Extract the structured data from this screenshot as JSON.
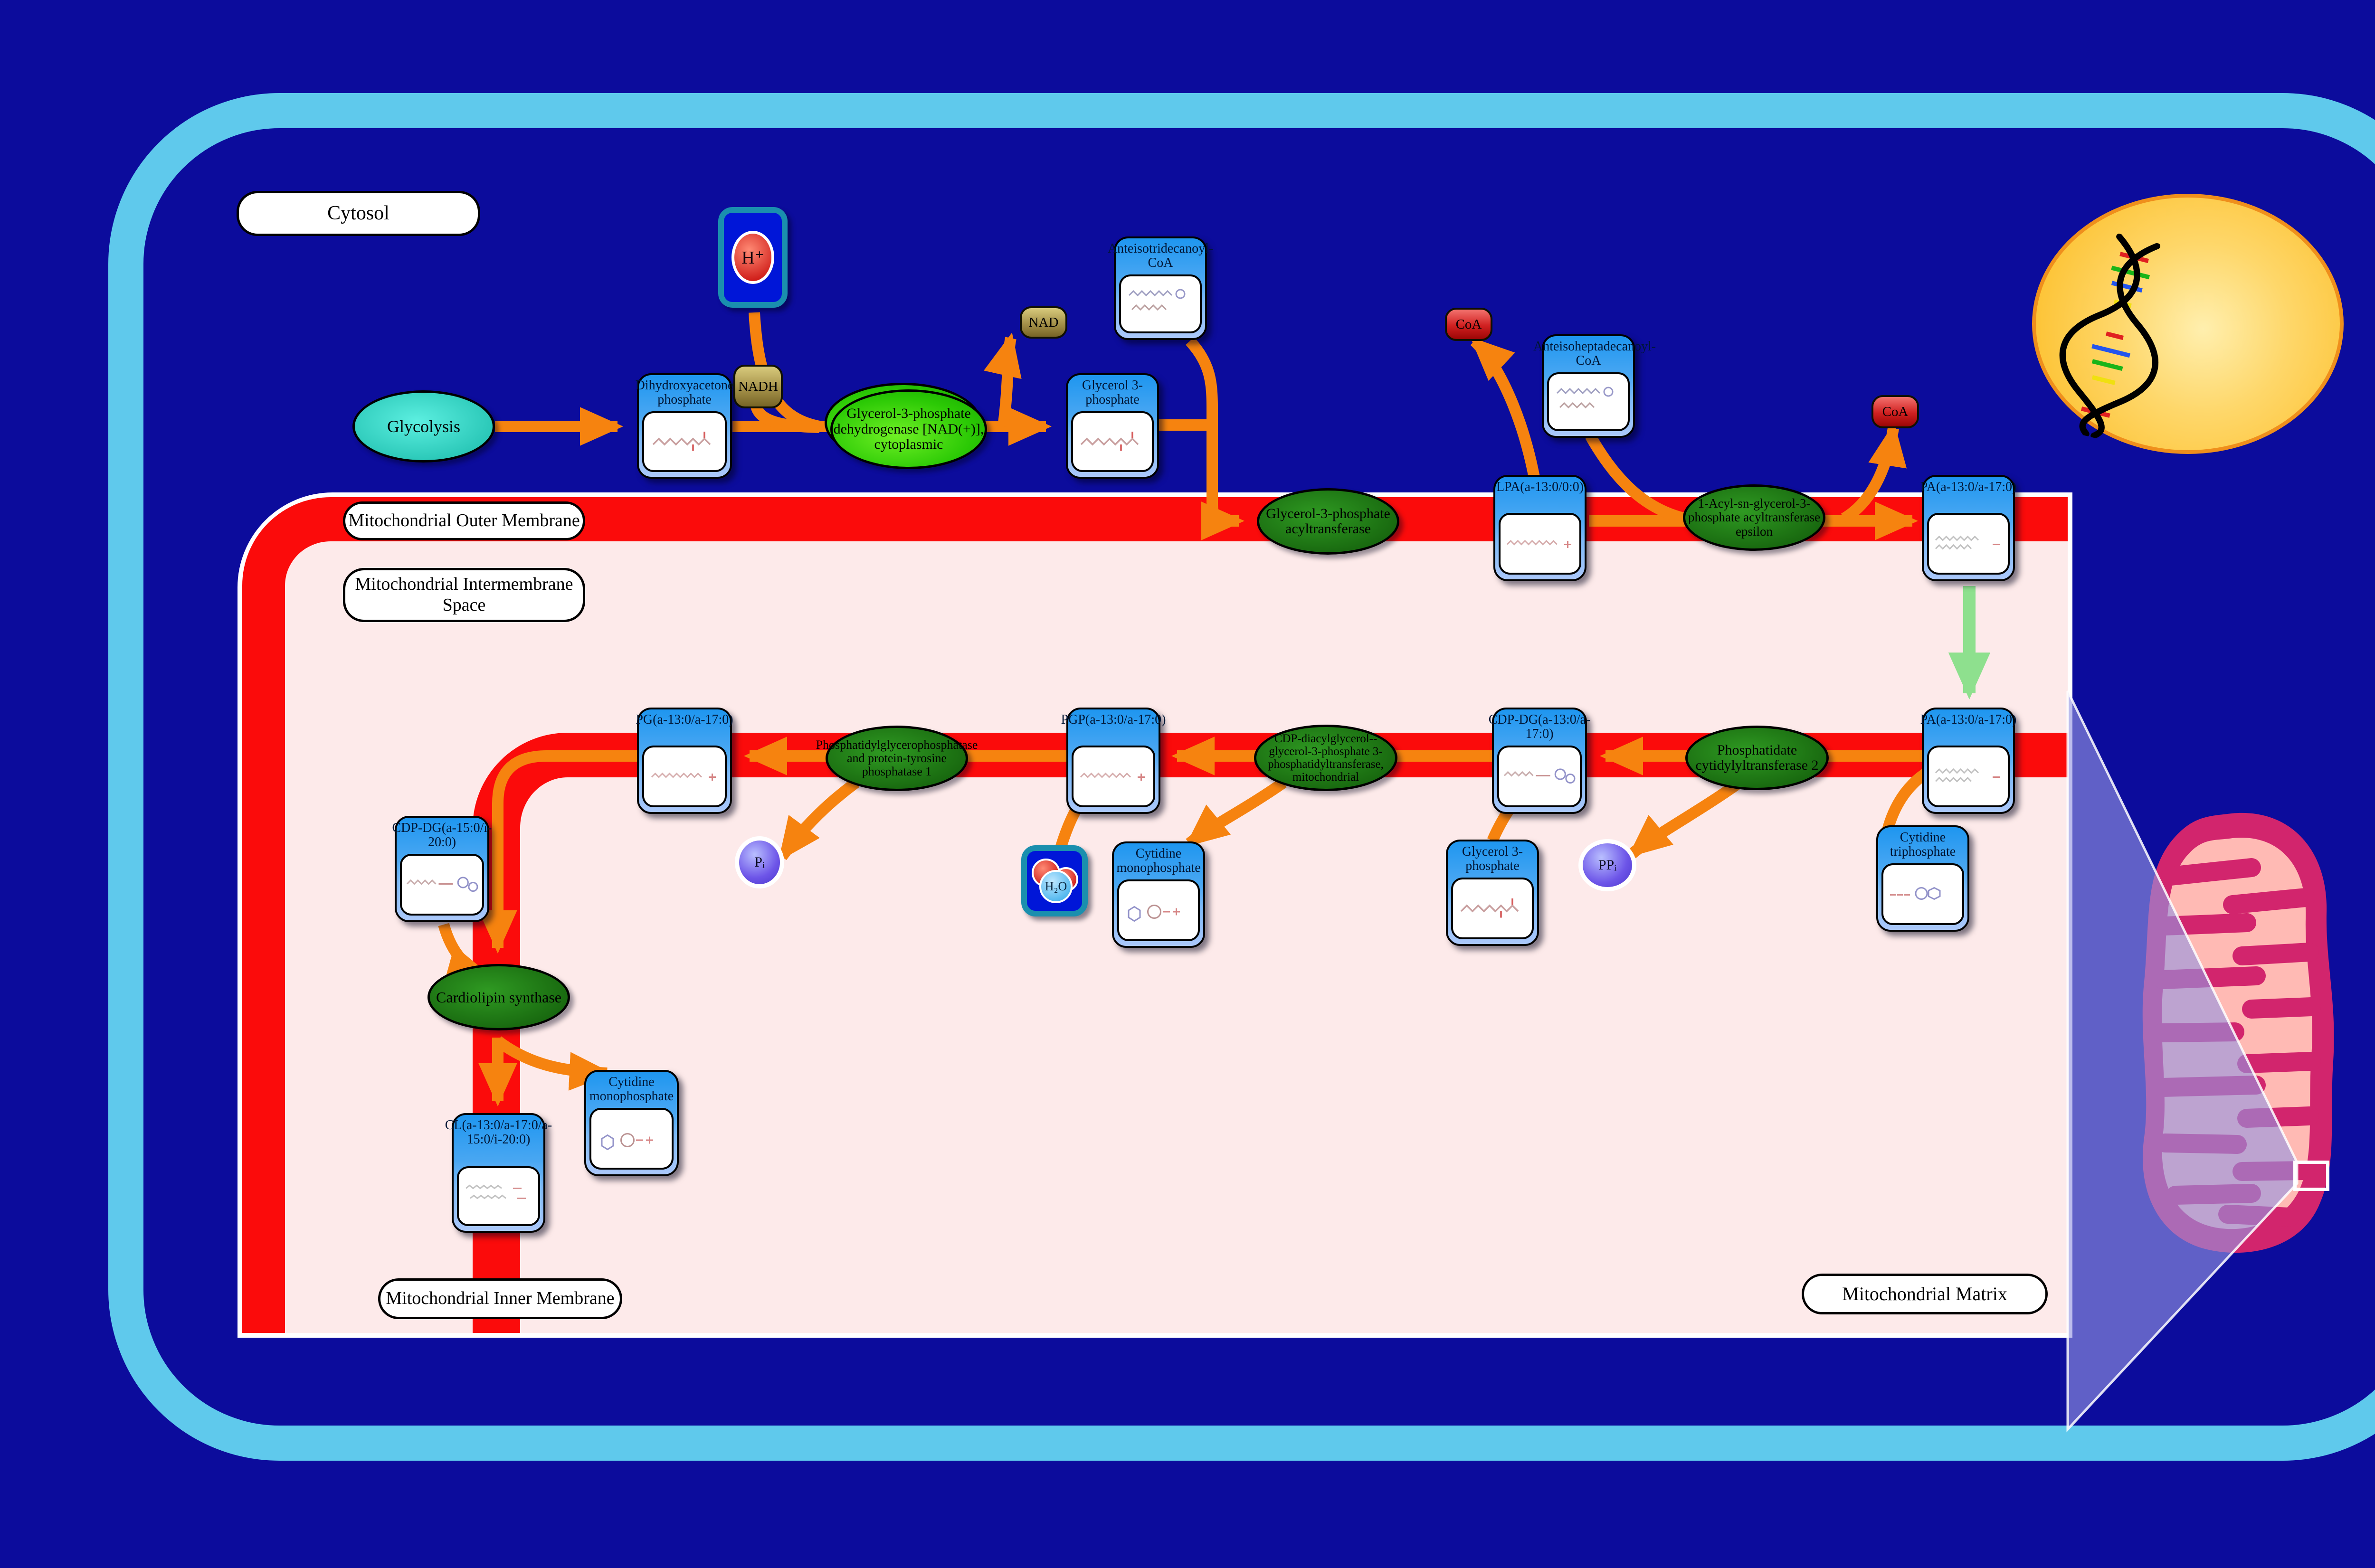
{
  "compartments": {
    "cytosol": "Cytosol",
    "outer_membrane": "Mitochondrial Outer Membrane",
    "intermembrane_space": "Mitochondrial Intermembrane Space",
    "inner_membrane": "Mitochondrial Inner Membrane",
    "matrix": "Mitochondrial Matrix"
  },
  "nodes": {
    "glycolysis": {
      "label": "Glycolysis"
    },
    "dhap": {
      "label": "Dihydroxyacetone phosphate"
    },
    "g3p_cytosol": {
      "label": "Glycerol 3-phosphate"
    },
    "anteisotridecanoyl_coa": {
      "label": "Anteisotridecanoyl-CoA"
    },
    "anteisoheptadecanoyl_coa": {
      "label": "Anteisoheptadecanoyl-CoA"
    },
    "lpa": {
      "label": "LPA(a-13:0/0:0)"
    },
    "pa_outer": {
      "label": "PA(a-13:0/a-17:0)"
    },
    "pa_inner": {
      "label": "PA(a-13:0/a-17:0)"
    },
    "cdp_dg": {
      "label": "CDP-DG(a-13:0/a-17:0)"
    },
    "pgp": {
      "label": "PGP(a-13:0/a-17:0)"
    },
    "pg": {
      "label": "PG(a-13:0/a-17:0)"
    },
    "cdp_dg_2": {
      "label": "CDP-DG(a-15:0/i-20:0)"
    },
    "cl": {
      "label": "CL(a-13:0/a-17:0/a-15:0/i-20:0)"
    },
    "ctp": {
      "label": "Cytidine triphosphate"
    },
    "g3p_ims": {
      "label": "Glycerol 3-phosphate"
    },
    "cmp_ims": {
      "label": "Cytidine monophosphate"
    },
    "cmp_matrix": {
      "label": "Cytidine monophosphate"
    },
    "nadh": {
      "label": "NADH"
    },
    "nad": {
      "label": "NAD"
    },
    "coa_1": {
      "label": "CoA"
    },
    "coa_2": {
      "label": "CoA"
    },
    "h_plus": {
      "label": "H⁺"
    },
    "h2o": {
      "label": "H₂O"
    },
    "pi": {
      "label": "Pᵢ"
    },
    "ppi": {
      "label": "PPᵢ"
    }
  },
  "enzymes": {
    "gpd1": {
      "label": "Glycerol-3-phosphate dehydrogenase [NAD(+)], cytoplasmic"
    },
    "gpat": {
      "label": "Glycerol-3-phosphate acyltransferase"
    },
    "agpat_epsilon": {
      "label": "1-Acyl-sn-glycerol-3-phosphate acyltransferase epsilon"
    },
    "cds2": {
      "label": "Phosphatidate cytidylyltransferase 2"
    },
    "pgs1": {
      "label": "CDP-diacylglycerol--glycerol-3-phosphate 3-phosphatidyltransferase, mitochondrial"
    },
    "ptpmt1": {
      "label": "Phosphatidylglycerophosphatase and protein-tyrosine phosphatase 1"
    },
    "cls": {
      "label": "Cardiolipin synthase"
    }
  },
  "colors": {
    "background": "#0c0c9c",
    "cell_border": "#5fc9ec",
    "membrane_red": "#fb0b0b",
    "intermembrane_pink": "#fdeaea",
    "arrow_orange": "#f6830f",
    "transport_arrow_green": "#8ee08e",
    "node_header_blue": "#1e96f0",
    "enzyme_dark_green": "#18680f",
    "enzyme_bright_green": "#2bc905",
    "glycolysis_teal": "#2cc9b9",
    "nucleus_yellow": "#fcba1c",
    "mitochondrion_crimson": "#d2256d"
  }
}
